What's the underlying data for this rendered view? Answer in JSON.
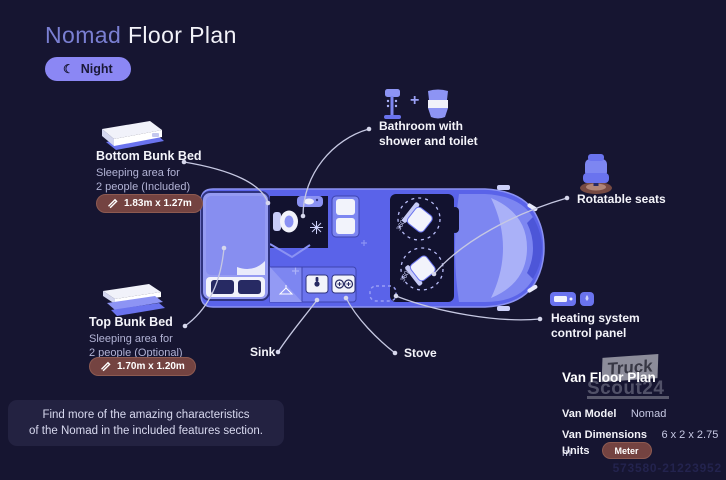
{
  "title": {
    "accent": "Nomad",
    "rest": "Floor Plan"
  },
  "mode_toggle": {
    "label": "Night"
  },
  "icons": {
    "moon": "☾",
    "plus": "+"
  },
  "callouts": {
    "bottom_bunk": {
      "title": "Bottom Bunk Bed",
      "desc_line1": "Sleeping area for",
      "desc_line2": "2 people (Included)",
      "dimensions": "1.83m x 1.27m"
    },
    "top_bunk": {
      "title": "Top Bunk Bed",
      "desc_line1": "Sleeping area for",
      "desc_line2": "2 people (Optional)",
      "dimensions": "1.70m x 1.20m"
    },
    "bathroom": {
      "line1": "Bathroom with",
      "line2": "shower and toilet"
    },
    "rotatable_seats": {
      "label": "Rotatable seats"
    },
    "heating": {
      "line1": "Heating system",
      "line2": "control panel"
    },
    "sink": {
      "label": "Sink"
    },
    "stove": {
      "label": "Stove"
    }
  },
  "floor_plan": {
    "seat_rotation": "360°"
  },
  "footer_note": {
    "line1": "Find more of the amazing characteristics",
    "line2": "of the Nomad in the included features section."
  },
  "van_info": {
    "title": "Van Floor Plan",
    "rows": [
      {
        "label": "Van Model",
        "value": "Nomad"
      },
      {
        "label": "Van Dimensions",
        "value": "6 x 2 x 2.75 m"
      },
      {
        "label": "Units",
        "value": "Meter"
      }
    ]
  },
  "watermark": {
    "line1": "Truck",
    "line2": "Scout24"
  },
  "reference_number": "573580-21223952",
  "colors": {
    "background": "#161531",
    "accent_purple": "#8b87f4",
    "van_body": "#5a63e9",
    "badge_brown": "#744341",
    "title_accent": "#7a7fd2",
    "muted_text": "#b2b3d5"
  }
}
